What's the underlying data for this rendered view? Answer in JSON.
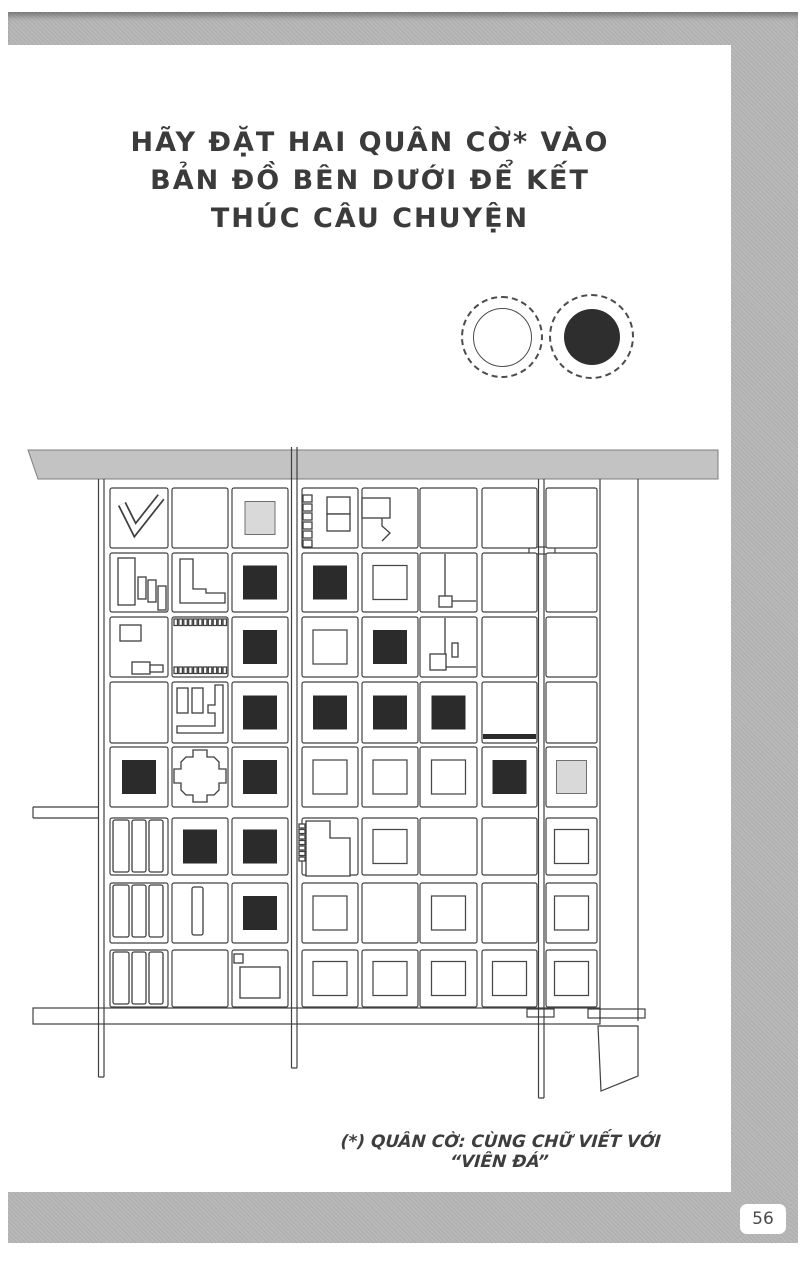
{
  "title": {
    "lines": [
      "HÃY ĐẶT HAI QUÂN CỜ* VÀO",
      "BẢN ĐỒ BÊN DƯỚI ĐỂ KẾT",
      "THÚC CÂU CHUYỆN"
    ]
  },
  "stones": [
    {
      "name": "white-stone",
      "filled": false
    },
    {
      "name": "black-stone",
      "filled": true
    }
  ],
  "footnote": {
    "text": "(*) QUÂN CỜ: CÙNG CHỮ VIẾT VỚI “VIÊN ĐÁ”"
  },
  "page_number": "56",
  "colors": {
    "ink": "#3f3f3f",
    "dark_square": "#2b2b2b",
    "shaded_square": "#d9d9d9",
    "border_gray": "#b6b6b6",
    "black_stone": "#2e2e2e",
    "paper": "#ffffff"
  },
  "map": {
    "rows": 8,
    "cols": 8,
    "grid": [
      [
        "chevron",
        "",
        "gray",
        "minisq_stack",
        "flag",
        "",
        "",
        ""
      ],
      [
        "rects",
        "lshape",
        "dark",
        "dark",
        "sq",
        "wire_a",
        "",
        ""
      ],
      [
        "sqtab",
        "comb",
        "dark",
        "sq",
        "dark",
        "wire_b",
        "",
        ""
      ],
      [
        "",
        "jwall",
        "dark",
        "dark",
        "dark",
        "dark",
        "hbar",
        ""
      ],
      [
        "dark",
        "castle",
        "dark",
        "sq",
        "sq",
        "sq",
        "dark",
        "gray"
      ],
      [
        "bars3",
        "dark",
        "dark",
        "combL",
        "sq",
        "",
        "",
        "sq"
      ],
      [
        "bars3",
        "bar1",
        "dark",
        "sq",
        "",
        "sq",
        "",
        "sq"
      ],
      [
        "bars3",
        "",
        "sq_pair",
        "sq",
        "sq",
        "sq",
        "sq",
        "sq"
      ]
    ]
  }
}
